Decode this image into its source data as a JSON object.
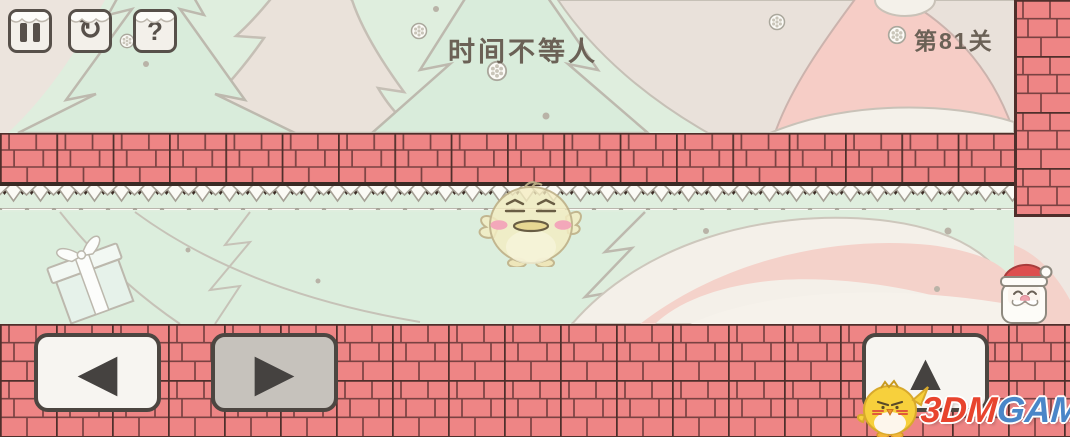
{
  "hud": {
    "title": "时间不等人",
    "level": "第81关"
  },
  "icons": {
    "restart_glyph": "↻",
    "hint_glyph": "?",
    "left_arrow_glyph": "◀",
    "right_arrow_glyph": "▶",
    "up_arrow_glyph": "▲",
    "snowflake_glyph": "❄"
  },
  "watermark": {
    "brand_left": "3DM",
    "brand_right": "GAME"
  },
  "colors": {
    "brick": "#ee8585",
    "brick_mortar": "#7a4242",
    "brick_border": "#4f2f2b",
    "background_mint": "#dfeede",
    "background_beige": "#e9e1da",
    "hat_pink": "#f6cdc6",
    "hud_text": "#6b6156",
    "button_face": "#f7f5f1",
    "button_pressed": "#c6c2bc",
    "brand_red": "#e8442e",
    "brand_blue": "#4a86c8"
  }
}
